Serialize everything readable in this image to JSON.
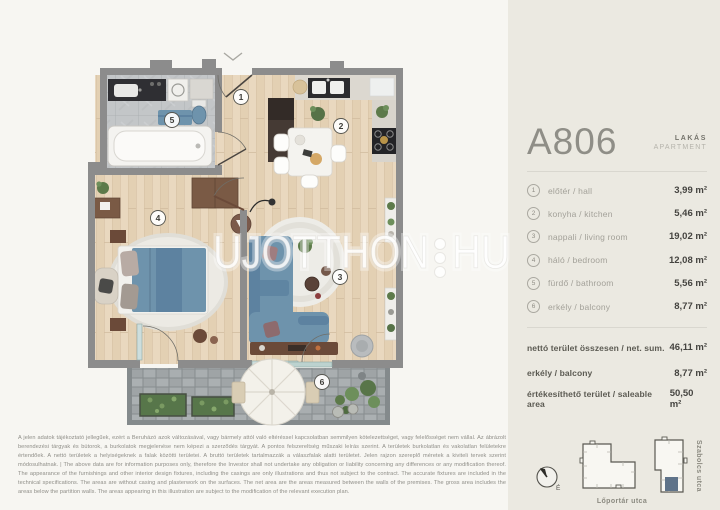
{
  "panel": {
    "unit_id": "A806",
    "type_hu": "LAKÁS",
    "type_en": "APARTMENT",
    "rooms": [
      {
        "n": "1",
        "label": "előtér / hall",
        "area": "3,99 m²"
      },
      {
        "n": "2",
        "label": "konyha / kitchen",
        "area": "5,46 m²"
      },
      {
        "n": "3",
        "label": "nappali / living room",
        "area": "19,02 m²"
      },
      {
        "n": "4",
        "label": "háló / bedroom",
        "area": "12,08 m²"
      },
      {
        "n": "5",
        "label": "fürdő / bathroom",
        "area": "5,56 m²"
      },
      {
        "n": "6",
        "label": "erkély / balcony",
        "area": "8,77 m²"
      }
    ],
    "totals": [
      {
        "label": "nettó terület összesen / net. sum.",
        "area": "46,11 m²"
      },
      {
        "label": "erkély / balcony",
        "area": "8,77 m²"
      },
      {
        "label": "értékesíthető terület / saleable area",
        "area": "50,50 m²"
      }
    ]
  },
  "plan": {
    "badges": [
      "1",
      "2",
      "3",
      "4",
      "5",
      "6"
    ]
  },
  "watermark": {
    "part1": "UJOTTHON",
    "part2": "HU"
  },
  "map": {
    "street_bottom": "Lőportár utca",
    "street_right": "Szabolcs utca",
    "compass": "É",
    "highlight_color": "#5f7389"
  },
  "colors": {
    "accent_blue": "#6e93ac",
    "wall_gray": "#8c8c8c",
    "panel_bg": "#ebe9e1"
  },
  "disclaimer": "A jelen adatok tájékoztató jellegűek, ezért a Beruházó azok változásával, vagy bármely attól való eltéréssel kapcsolatban semmilyen kötelezettséget, vagy felelősséget nem vállal. Az ábrázolt berendezési tárgyak és bútorok, a burkolatok megjelenése nem képezi a szerződés tárgyát. A pontos felszereltség műszaki leírás szerint. A területek burkolatlan és vakolatlan felületekre értendőek. A nettó területek a helyiségeknek a falak közötti területei. A bruttó területek tartalmazzák a válaszfalak alatti területet. Jelen rajzon szereplő méretek a kiviteli tervek szerint módosulhatnak. | The above data are for information purposes only, therefore the Investor shall not undertake any obligation or liability concerning any differences or any modification thereof. The appearance of the furnishings and other interior design fixtures, including the casings are only illustrations and thus not subject to the contract. The accurate fixtures are included in the technical specifications. The areas are without casing and plasterwork on the surfaces. The net area are the areas measured between the walls of the premises. The gross area includes the areas below the partition walls. The areas appearing in this illustration are subject to the modification of the relevant execution plan."
}
